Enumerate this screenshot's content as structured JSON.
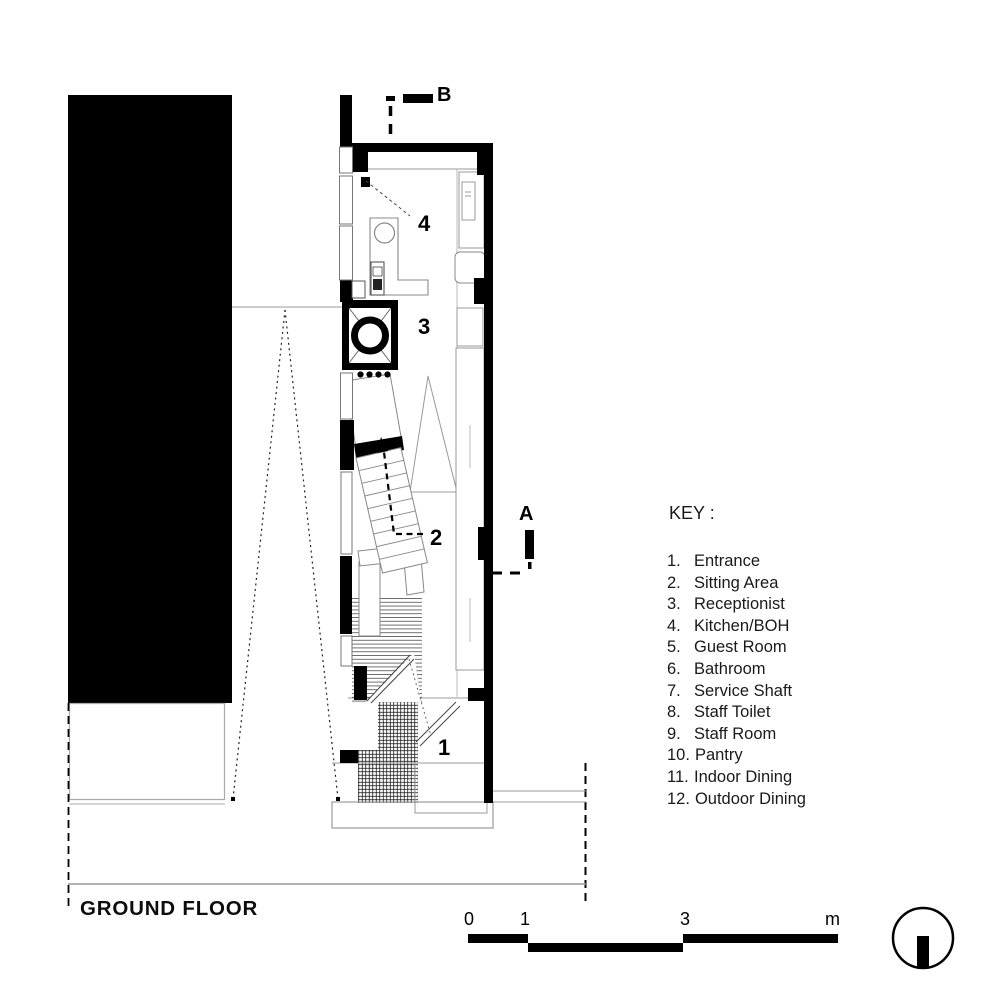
{
  "drawing": {
    "title": "GROUND FLOOR",
    "room_numbers": [
      {
        "id": "entrance",
        "label": "1"
      },
      {
        "id": "sitting-area",
        "label": "2"
      },
      {
        "id": "receptionist",
        "label": "3"
      },
      {
        "id": "kitchen-boh",
        "label": "4"
      }
    ],
    "section_markers": {
      "a": "A",
      "b": "B"
    }
  },
  "key": {
    "heading": "KEY :",
    "items": [
      {
        "num": "1.",
        "label": "Entrance"
      },
      {
        "num": "2.",
        "label": "Sitting Area"
      },
      {
        "num": "3.",
        "label": "Receptionist"
      },
      {
        "num": "4.",
        "label": "Kitchen/BOH"
      },
      {
        "num": "5.",
        "label": "Guest Room"
      },
      {
        "num": "6.",
        "label": "Bathroom"
      },
      {
        "num": "7.",
        "label": "Service Shaft"
      },
      {
        "num": "8.",
        "label": "Staff Toilet"
      },
      {
        "num": "9.",
        "label": "Staff Room"
      },
      {
        "num": "10.",
        "label": "Pantry"
      },
      {
        "num": "11.",
        "label": "Indoor Dining"
      },
      {
        "num": "12.",
        "label": "Outdoor Dining"
      }
    ]
  },
  "scale_bar": {
    "labels": [
      "0",
      "1",
      "3",
      "m"
    ]
  },
  "icons": {
    "north": "north-indicator-icon",
    "section_cut": "section-cut-icon"
  },
  "colors": {
    "ink": "#000000",
    "thin_line": "#999999"
  }
}
